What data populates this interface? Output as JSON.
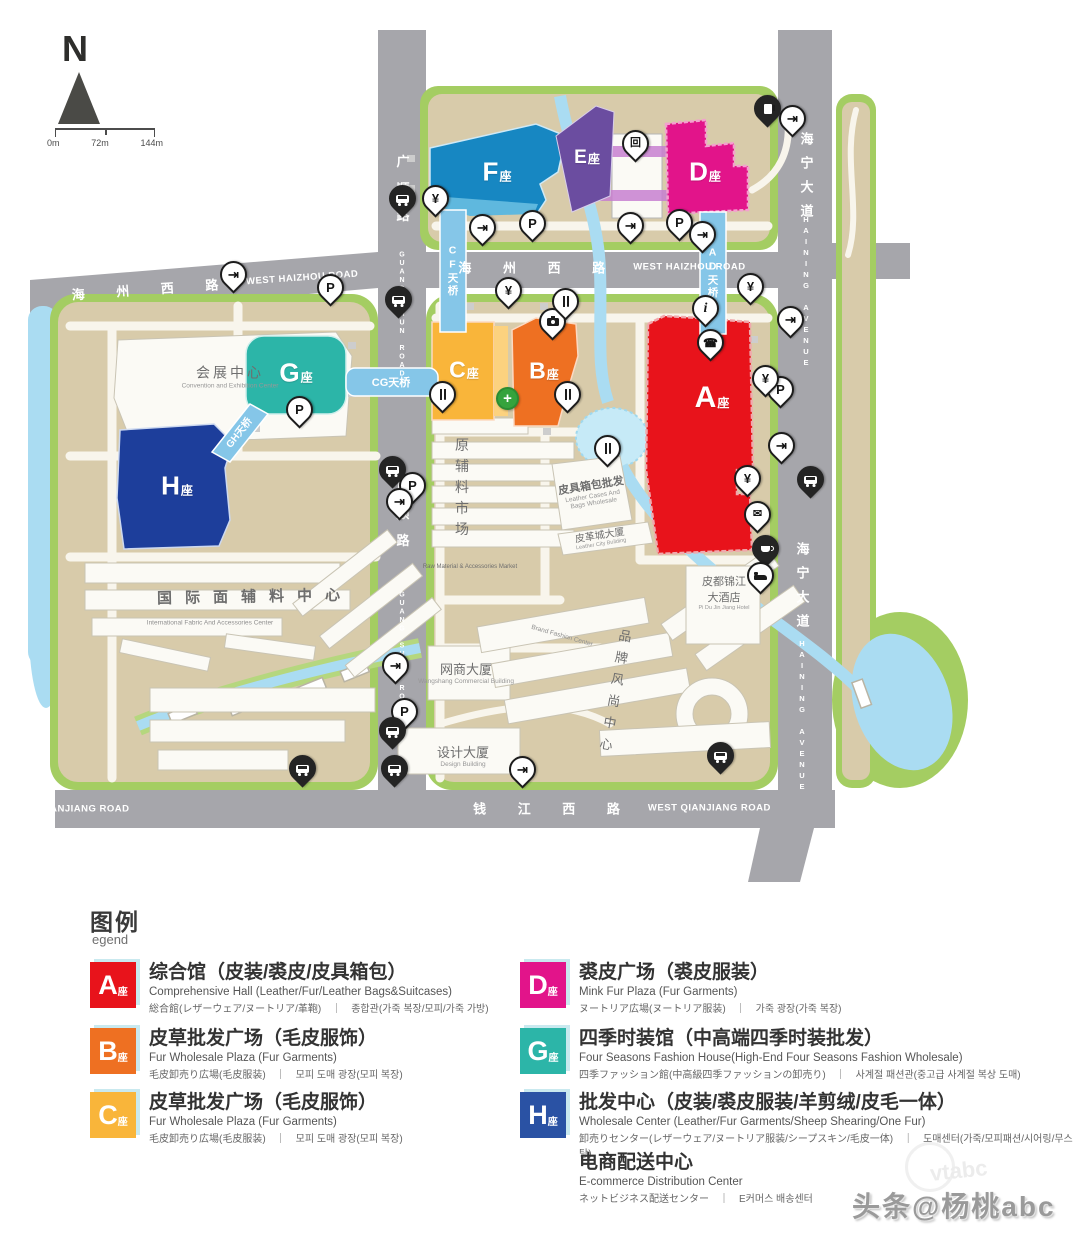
{
  "map": {
    "compass_n": "N",
    "scale": {
      "t0": "0m",
      "t1": "72m",
      "t2": "144m"
    },
    "roads": {
      "haizhou_cn": "海 州 西 路",
      "haizhou_en": "WEST HAIZHOU ROAD",
      "qianjiang_cn": "钱 江 西 路",
      "qianjiang_en": "WEST QIANJIANG ROAD",
      "haining_cn": "海宁大道",
      "haining_en": "HAINING AVENUE",
      "guangshun_cn": "广顺路",
      "guangshun_en": "GUANG SHUN ROAD"
    },
    "bridges": {
      "cf": "CF天桥",
      "ad": "AD天桥",
      "cg": "CG天桥",
      "gh": "GH天桥"
    },
    "blocks": {
      "a": {
        "l": "A",
        "s": "座"
      },
      "b": {
        "l": "B",
        "s": "座"
      },
      "c": {
        "l": "C",
        "s": "座"
      },
      "d": {
        "l": "D",
        "s": "座"
      },
      "e": {
        "l": "E",
        "s": "座"
      },
      "f": {
        "l": "F",
        "s": "座"
      },
      "g": {
        "l": "G",
        "s": "座"
      },
      "h": {
        "l": "H",
        "s": "座"
      }
    },
    "places": {
      "convention_cn": "会展中心",
      "convention_en": "Convention and Exhibition Center",
      "intl_cn": "国际面辅料中心",
      "intl_en": "International Fabric And Accessories Center",
      "raw_cn": "原辅料市场",
      "raw_en": "Raw Material & Accessories Market",
      "bags_cn": "皮具箱包批发",
      "bags_en1": "Leather Cases And",
      "bags_en2": "Bags Wholesale",
      "lcity_cn": "皮革城大厦",
      "lcity_en": "Leather City Building",
      "wang_cn": "网商大厦",
      "wang_en": "Wangshang Commercial Building",
      "design_cn": "设计大厦",
      "design_en": "Design Building",
      "brand_cn": "品牌风尚中心",
      "brand_en": "Brand Fashion Center",
      "hotel_cn1": "皮都锦江",
      "hotel_cn2": "大酒店",
      "hotel_en": "Pi Du Jin Jiang Hotel"
    },
    "symbols": {
      "p": "P",
      "yen": "¥",
      "exit": "⇥",
      "info": "i",
      "phone": "☎",
      "mail": "✉",
      "cross": "+",
      "garage": "回"
    }
  },
  "colors": {
    "a": "#e8131b",
    "b": "#ee7022",
    "c": "#f9b53a",
    "d": "#e2148a",
    "e": "#6b4da0",
    "f": "#1787c2",
    "g": "#2cb5a8",
    "h": "#2a52a4",
    "road": "#a6a6ab",
    "green": "#a4cd62",
    "ground": "#d8cbaa",
    "water": "#aadcf2",
    "bridge": "#85c6e8"
  },
  "legend": {
    "title": "图例",
    "subtitle": "egend",
    "a": {
      "letter": "A",
      "suffix": "座",
      "title": "综合馆（皮装/裘皮/皮具箱包）",
      "en": "Comprehensive Hall (Leather/Fur/Leather Bags&Suitcases)",
      "jk": "総合館(レザーウェア/ヌートリア/革鞄)　｜　종합관(가죽 복장/모피/가죽 가방)"
    },
    "b": {
      "letter": "B",
      "suffix": "座",
      "title": "皮草批发广场（毛皮服饰）",
      "en": "Fur Wholesale Plaza (Fur Garments)",
      "jk": "毛皮卸売り広場(毛皮服装)　｜　모피 도매 광장(모피 복장)"
    },
    "c": {
      "letter": "C",
      "suffix": "座",
      "title": "皮草批发广场（毛皮服饰）",
      "en": "Fur Wholesale Plaza (Fur Garments)",
      "jk": "毛皮卸売り広場(毛皮服装)　｜　모피 도매 광장(모피 복장)"
    },
    "d": {
      "letter": "D",
      "suffix": "座",
      "title": "裘皮广场（裘皮服装）",
      "en": "Mink Fur Plaza (Fur Garments)",
      "jk": "ヌートリア広場(ヌートリア服装)　｜　가죽 광장(가죽 복장)"
    },
    "g": {
      "letter": "G",
      "suffix": "座",
      "title": "四季时装馆（中高端四季时装批发）",
      "en": "Four Seasons Fashion House(High-End Four Seasons Fashion Wholesale)",
      "jk": "四季ファッション館(中高級四季ファッションの卸売り)　｜　사계절 패션관(중고급 사계절 복상 도매)"
    },
    "h": {
      "letter": "H",
      "suffix": "座",
      "title": "批发中心（皮装/裘皮服装/羊剪绒/皮毛一体）",
      "en": "Wholesale Center (Leather/Fur Garments/Sheep Shearing/One Fur)",
      "jk": "卸売りセンター(レザーウェア/ヌートリア服装/シープスキン/毛皮一体)　｜　도매센터(가죽/모피패션/시어링/무스탕)"
    },
    "ec": {
      "title": "电商配送中心",
      "en": "E-commerce Distribution Center",
      "jk": "ネットビジネス配送センター　｜　E커머스 배송센터"
    }
  },
  "watermark": {
    "text": "头条@杨桃abc",
    "ghost": "vtabc"
  }
}
